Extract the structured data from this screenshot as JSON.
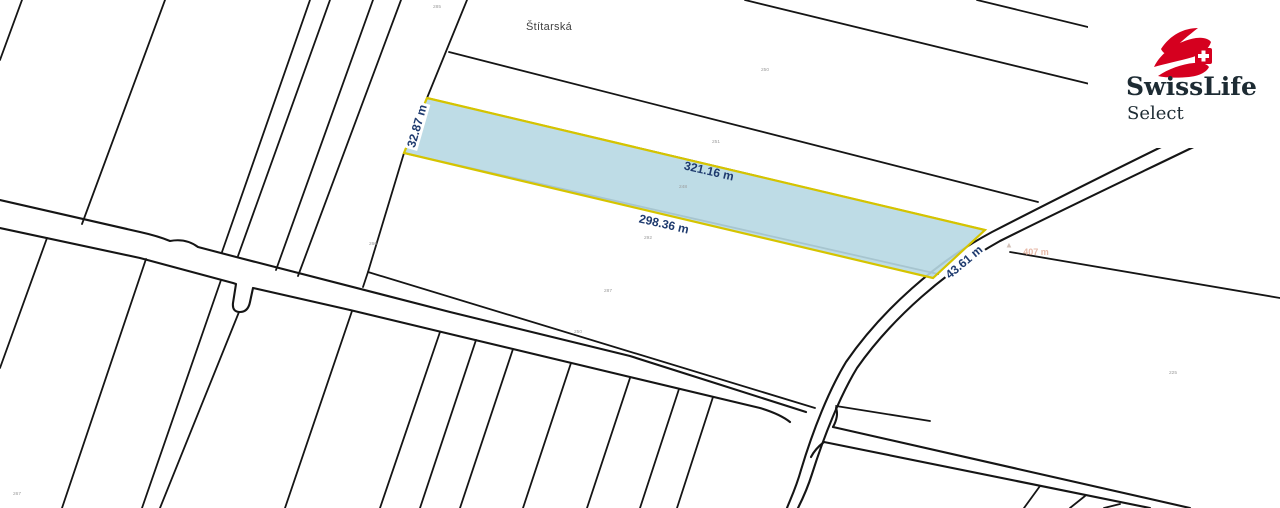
{
  "map": {
    "street_label": "Štítarská",
    "highlighted_parcel": {
      "fill_color": "#b7d8e3",
      "outline_color": "#d5c400",
      "dimension_color": "#1e3a6e",
      "dimensions": {
        "left_edge": "32.87 m",
        "top_edge": "321.16 m",
        "bottom_edge": "298.36 m",
        "right_edge": "43.61 m"
      }
    },
    "area_note": {
      "text": "407 m",
      "color": "#dfa28b",
      "icon": "triangle-marker"
    },
    "parcel_numbers": [
      "285",
      "250",
      "251",
      "248",
      "292",
      "287",
      "250",
      "260",
      "225",
      "267"
    ],
    "line_color": "#151515"
  },
  "logo": {
    "brand": "SwissLife",
    "sub_brand": "Select",
    "accent_color": "#d5001f",
    "icon": "swisslife-swoosh-swiss-cross"
  }
}
